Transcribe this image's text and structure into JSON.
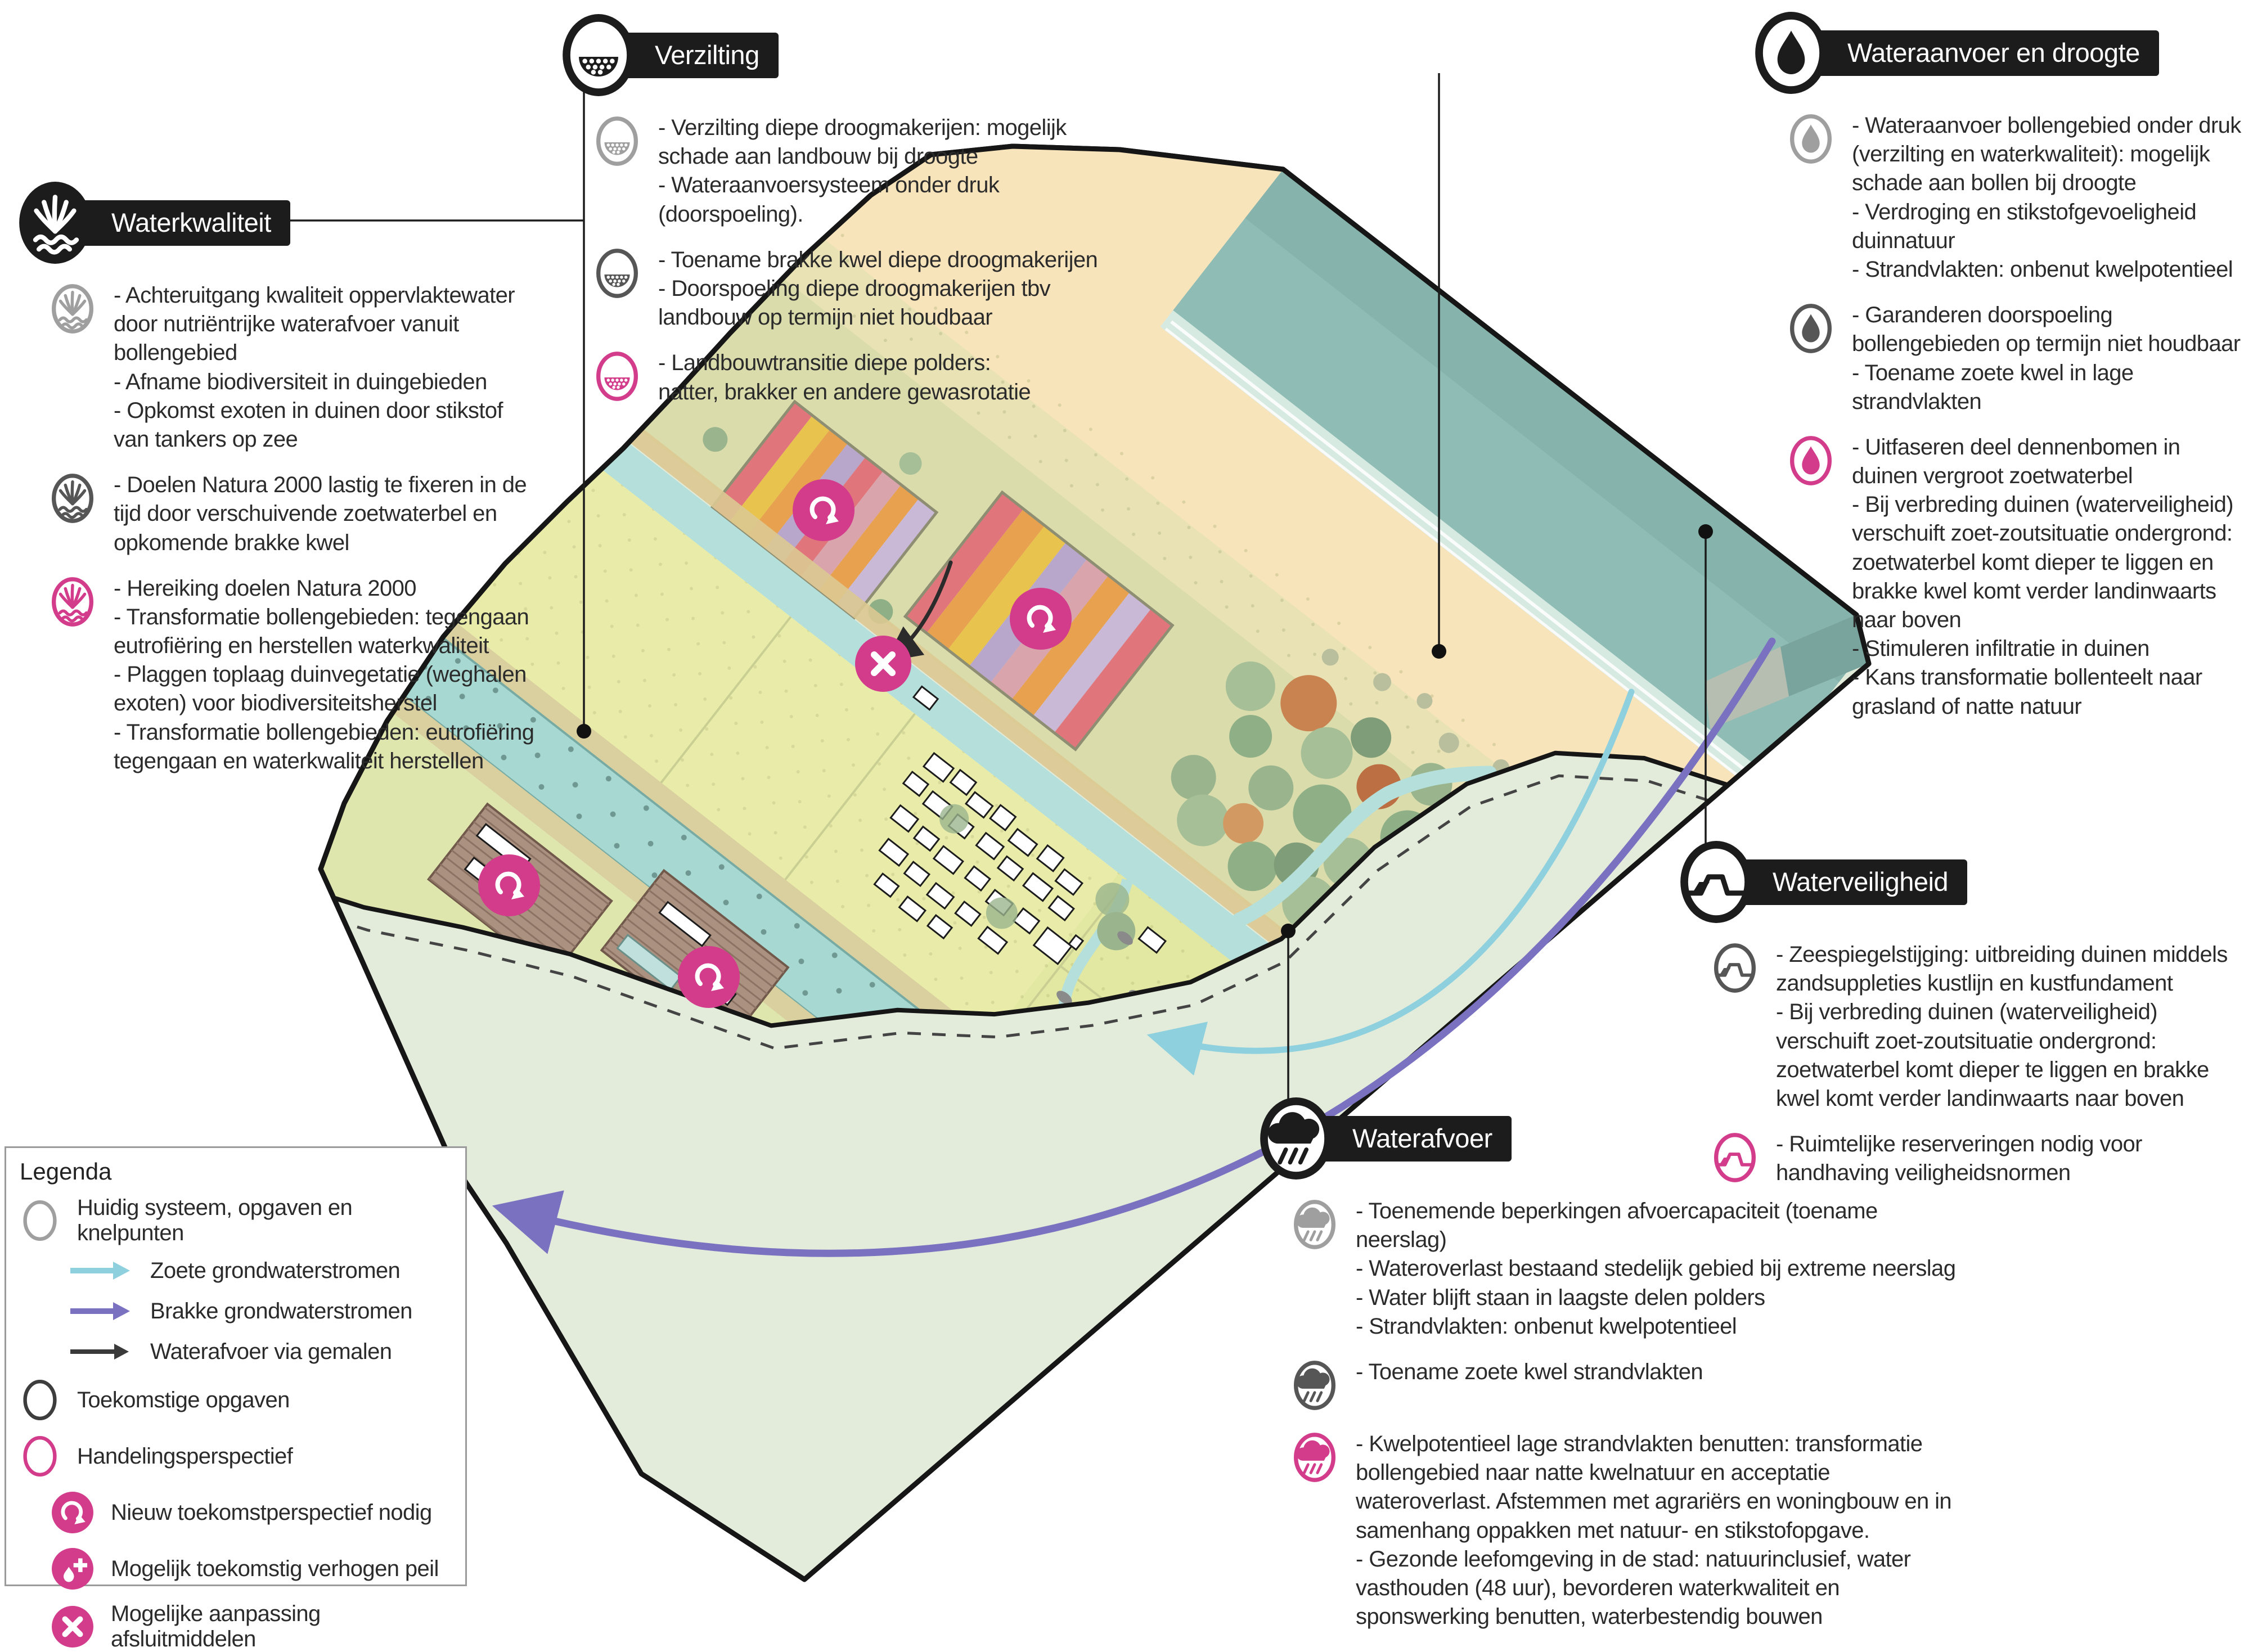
{
  "sections": {
    "waterkwaliteit": {
      "title": "Waterkwaliteit",
      "items": [
        {
          "icon": "reed-icon",
          "state": "huidig",
          "text": "- Achteruitgang kwaliteit oppervlaktewater door nutriëntrijke waterafvoer vanuit bollengebied\n- Afname biodiversiteit in duingebieden\n- Opkomst exoten in duinen door stikstof van tankers op zee"
        },
        {
          "icon": "reed-icon",
          "state": "toekomstig",
          "text": "- Doelen Natura 2000 lastig te fixeren in de tijd door verschuivende zoetwaterbel en opkomende brakke kwel"
        },
        {
          "icon": "reed-icon",
          "state": "handelingsperspectief",
          "text": "- Hereiking doelen Natura 2000\n- Transformatie bollengebieden: tegengaan eutrofiëring en herstellen waterkwaliteit\n- Plaggen toplaag duinvegetatie (weghalen exoten) voor biodiversiteitsherstel\n- Transformatie bollengebieden: eutrofiëring tegengaan en waterkwaliteit herstellen"
        }
      ]
    },
    "verzilting": {
      "title": "Verzilting",
      "items": [
        {
          "icon": "salt-icon",
          "state": "huidig",
          "text": "- Verzilting diepe droogmakerijen: mogelijk schade aan landbouw bij droogte\n- Wateraanvoersysteem onder druk (doorspoeling)."
        },
        {
          "icon": "salt-icon",
          "state": "toekomstig",
          "text": "- Toename brakke kwel diepe droogmakerijen\n- Doorspoeling diepe droogmakerijen tbv landbouw op termijn niet houdbaar"
        },
        {
          "icon": "salt-icon",
          "state": "handelingsperspectief",
          "text": "- Landbouwtransitie diepe polders:\nnatter, brakker en andere gewasrotatie"
        }
      ]
    },
    "wateraanvoer": {
      "title": "Wateraanvoer en droogte",
      "items": [
        {
          "icon": "drop-icon",
          "state": "huidig",
          "text": "- Wateraanvoer bollengebied onder druk (verzilting en waterkwaliteit): mogelijk schade aan bollen bij droogte\n- Verdroging en stikstofgevoeligheid duinnatuur\n- Strandvlakten: onbenut kwelpotentieel"
        },
        {
          "icon": "drop-icon",
          "state": "toekomstig",
          "text": "- Garanderen doorspoeling bollengebieden op termijn niet houdbaar\n- Toename zoete kwel in lage strandvlakten"
        },
        {
          "icon": "drop-icon",
          "state": "handelingsperspectief",
          "text": "- Uitfaseren deel dennenbomen in duinen vergroot zoetwaterbel\n- Bij verbreding duinen (waterveiligheid) verschuift zoet-zoutsituatie ondergrond: zoetwaterbel komt dieper te liggen en brakke kwel komt verder landinwaarts naar boven\n- Stimuleren infiltratie in duinen\n- Kans transformatie bollenteelt naar grasland of natte natuur"
        }
      ]
    },
    "waterveiligheid": {
      "title": "Waterveiligheid",
      "items": [
        {
          "icon": "dune-icon",
          "state": "toekomstig",
          "text": "- Zeespiegelstijging: uitbreiding duinen middels zandsuppleties kustlijn en kustfundament\n- Bij verbreding duinen (waterveiligheid) verschuift zoet-zoutsituatie ondergrond: zoetwaterbel komt dieper te liggen en brakke kwel komt verder landinwaarts naar boven"
        },
        {
          "icon": "dune-icon",
          "state": "handelingsperspectief",
          "text": "- Ruimtelijke reserveringen nodig voor handhaving veiligheidsnormen"
        }
      ]
    },
    "waterafvoer": {
      "title": "Waterafvoer",
      "items": [
        {
          "icon": "rain-cloud-icon",
          "state": "huidig",
          "text": "- Toenemende beperkingen afvoercapaciteit (toename neerslag)\n- Wateroverlast bestaand stedelijk gebied bij extreme neerslag\n- Water blijft staan in laagste delen polders\n- Strandvlakten: onbenut kwelpotentieel"
        },
        {
          "icon": "rain-cloud-icon",
          "state": "toekomstig",
          "text": "- Toename zoete kwel strandvlakten"
        },
        {
          "icon": "rain-cloud-icon",
          "state": "handelingsperspectief",
          "text": "- Kwelpotentieel lage strandvlakten benutten: transformatie bollengebied naar natte kwelnatuur en acceptatie wateroverlast. Afstemmen met agrariërs en woningbouw en in samenhang oppakken met natuur- en stikstofopgave.\n- Gezonde leefomgeving in de stad: natuurinclusief, water vasthouden (48 uur), bevorderen waterkwaliteit en sponswerking benutten, waterbestendig bouwen"
        }
      ]
    }
  },
  "legend": {
    "title": "Legenda",
    "items": [
      {
        "icon": "circle-outline-gray-icon",
        "label": "Huidig systeem, opgaven en knelpunten"
      },
      {
        "icon": "arrow-cyan-icon",
        "label": "Zoete grondwaterstromen"
      },
      {
        "icon": "arrow-purple-icon",
        "label": "Brakke grondwaterstromen"
      },
      {
        "icon": "arrow-black-icon",
        "label": "Waterafvoer via gemalen"
      },
      {
        "icon": "circle-outline-dark-icon",
        "label": "Toekomstige opgaven"
      },
      {
        "icon": "circle-outline-pink-icon",
        "label": "Handelingsperspectief"
      },
      {
        "icon": "renew-icon",
        "label": "Nieuw toekomstperspectief nodig"
      },
      {
        "icon": "raise-level-icon",
        "label": "Mogelijk toekomstig verhogen peil"
      },
      {
        "icon": "close-icon",
        "label": "Mogelijke aanpassing afsluitmiddelen"
      }
    ]
  },
  "palette": {
    "accent_pink": "#d23c8b",
    "state_huidig_gray": "#9f9f9f",
    "state_toekomstig_dark": "#565656",
    "header_black": "#1c1c1c",
    "arrow_fresh_groundwater": "#8ed0dd",
    "arrow_brackish_groundwater": "#7a72c0",
    "arrow_discharge": "#2b2b2b",
    "sea": "#8fbcb4",
    "beach": "#f8e4ba",
    "cut_face": "#e3ecdb",
    "canal": "#a7d9d2",
    "fields": "#e9eca9",
    "polder_soil": "#ab9180"
  }
}
